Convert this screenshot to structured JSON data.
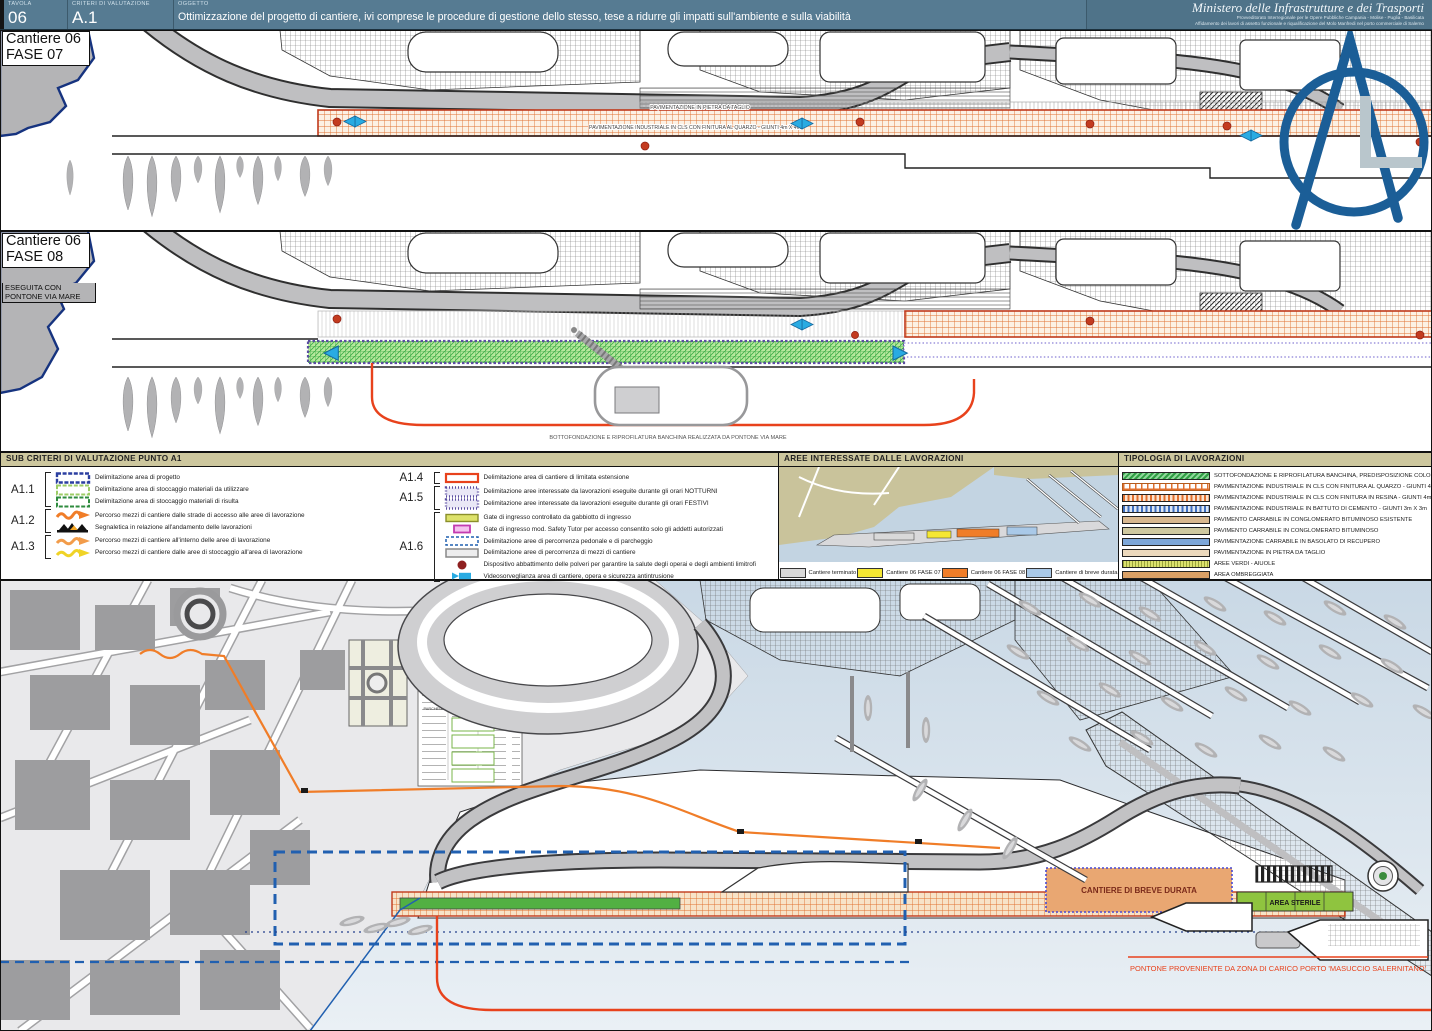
{
  "header": {
    "tavola_label": "TAVOLA",
    "tavola_value": "06",
    "criteri_label": "CRITERI DI VALUTAZIONE",
    "criteri_value": "A.1",
    "oggetto_label": "OGGETTO",
    "oggetto_text": "Ottimizzazione del progetto di cantiere, ivi comprese le procedure di gestione dello stesso, tese a ridurre gli impatti sull'ambiente e sulla viabilità",
    "ministry": "Ministero delle Infrastrutture e dei Trasporti",
    "ministry_sub1": "Provveditorato Interregionale per le Opere Pubbliche Campania - Molise - Puglia - Basilicata",
    "ministry_sub2": "Affidamento dei lavori di assetto funzionale e riqualificazione del Molo Manfredi nel porto commerciale di Salerno"
  },
  "phase1": {
    "title_line1": "Cantiere 06",
    "title_line2": "FASE 07",
    "label_pietra": "PAVIMENTAZIONE IN PIETRA DA TAGLIO",
    "label_industriale": "PAVIMENTAZIONE INDUSTRIALE IN CLS CON FINITURA AL QUARZO - GIUNTI 4m X 4m"
  },
  "phase2": {
    "title_line1": "Cantiere 06",
    "title_line2": "FASE 08",
    "subtitle": "ESEGUITA CON PONTONE VIA MARE",
    "caption": "BOTTOFONDAZIONE E RIPROFILATURA BANCHINA REALIZZATA DA PONTONE VIA MARE"
  },
  "sub_criteri": {
    "title": "SUB CRITERI DI VALUTAZIONE PUNTO A1",
    "groups": [
      {
        "code": "A1.1",
        "items": [
          {
            "swatch": "rect-blue",
            "label": "Delimitazione area di progetto"
          },
          {
            "swatch": "rect-lightgreen",
            "label": "Delimitazione area di stoccaggio materiali da utilizzare"
          },
          {
            "swatch": "rect-green",
            "label": "Delimitazione area di stoccaggio materiali di risulta"
          }
        ]
      },
      {
        "code": "A1.2",
        "items": [
          {
            "swatch": "arrow-orange",
            "label": "Percorso mezzi di cantiere dalle strade di accesso alle aree di lavorazione"
          },
          {
            "swatch": "signal",
            "label": "Segnaletica in relazione all'andamento delle lavorazioni"
          }
        ]
      },
      {
        "code": "A1.3",
        "items": [
          {
            "swatch": "arrow-orange2",
            "label": "Percorso mezzi di cantiere all'interno delle aree di lavorazione"
          },
          {
            "swatch": "arrow-yellow",
            "label": "Percorso mezzi di cantiere dalle aree di stoccaggio all'area di lavorazione"
          }
        ]
      },
      {
        "code": "A1.4",
        "items": [
          {
            "swatch": "rect-red",
            "label": "Delimitazione area di cantiere di limitata estensione"
          }
        ]
      },
      {
        "code": "A1.5",
        "items": [
          {
            "swatch": "rect-dot-purple",
            "label": "Delimitazione aree interessate da lavorazioni eseguite durante gli orari NOTTURNI"
          },
          {
            "swatch": "rect-dot-purple",
            "label": "Delimitazione aree interessate da lavorazioni eseguite durante gli orari FESTIVI"
          }
        ]
      },
      {
        "code": "A1.6",
        "items": [
          {
            "swatch": "rect-yellowgreen",
            "label": "Gate di ingresso controllato da gabbiotto di ingresso"
          },
          {
            "swatch": "rect-pink",
            "label": "Gate di ingresso mod. Safety Tutor per accesso consentito solo gli addetti autorizzati"
          },
          {
            "swatch": "rect-dash-blue",
            "label": "Delimitazione aree di percorrenza pedonale e di parcheggio"
          },
          {
            "swatch": "rect-gray",
            "label": "Delimitazione aree di percorrenza di mezzi di cantiere"
          },
          {
            "swatch": "dot-darkred",
            "label": "Dispositivo abbattimento delle polveri per garantire la salute degli operai e degli ambienti limitrofi"
          },
          {
            "swatch": "camera-cyan",
            "label": "Videosorveglianza area di cantiere, opera e sicurezza antintrusione"
          }
        ]
      }
    ]
  },
  "aree_panel": {
    "title": "AREE INTERESSATE DALLE LAVORAZIONI",
    "legend": [
      {
        "color": "#d9d9d9",
        "label": "Cantiere terminato"
      },
      {
        "color": "#f5e733",
        "label": "Cantiere 06 FASE 07"
      },
      {
        "color": "#f07d28",
        "label": "Cantiere 06 FASE 08"
      },
      {
        "color": "#a9c9e8",
        "label": "Cantiere di breve durata"
      }
    ]
  },
  "tipologia_panel": {
    "title": "TIPOLOGIA DI LAVORAZIONI",
    "items": [
      {
        "swatch": "green-hatch",
        "label": "SOTTOFONDAZIONE E RIPROFILATURA BANCHINA, PREDISPOSIZIONE COLONNE DI SERVIZIO E PASSERELLE"
      },
      {
        "swatch": "orange-grid",
        "label": "PAVIMENTAZIONE INDUSTRIALE IN CLS CON FINITURA AL QUARZO - GIUNTI 4m X 4m"
      },
      {
        "swatch": "orange-dots",
        "label": "PAVIMENTAZIONE INDUSTRIALE IN CLS CON FINITURA IN RESINA - GIUNTI 4m X 4m"
      },
      {
        "swatch": "blue-dots",
        "label": "PAVIMENTAZIONE INDUSTRIALE IN BATTUTO DI CEMENTO - GIUNTI 3m X 3m"
      },
      {
        "swatch": "tan",
        "label": "PAVIMENTO CARRABILE IN CONGLOMERATO BITUMINOSO ESISTENTE"
      },
      {
        "swatch": "khaki",
        "label": "PAVIMENTO CARRABILE IN CONGLOMERATO BITUMINOSO"
      },
      {
        "swatch": "blue",
        "label": "PAVIMENTAZIONE CARRABILE IN BASOLATO DI RECUPERO"
      },
      {
        "swatch": "tan2",
        "label": "PAVIMENTAZIONE IN PIETRA DA TAGLIO"
      },
      {
        "swatch": "verde",
        "label": "AREE VERDI - AIUOLE"
      },
      {
        "swatch": "ombra",
        "label": "AREA OMBREGGIATA"
      }
    ]
  },
  "map": {
    "cantiere_breve": "CANTIERE DI BREVE DURATA",
    "area_sterile": "AREA STERILE",
    "pontone_text": "PONTONE  PROVENIENTE DA ZONA DI CARICO PORTO 'MASUCCIO SALERNITANO'",
    "parcheggio": "PARCHEGGIO RISERVATO CAPITANERIA DI PORTO"
  },
  "colors": {
    "accent_orange": "#f07d28",
    "accent_red": "#e8421c",
    "accent_green": "#52b043",
    "accent_cyan": "#29abe2",
    "panel_header": "#cdc79e",
    "titlebar": "#567b92",
    "logo_blue": "#1b5e97",
    "navy": "#2160b0"
  }
}
